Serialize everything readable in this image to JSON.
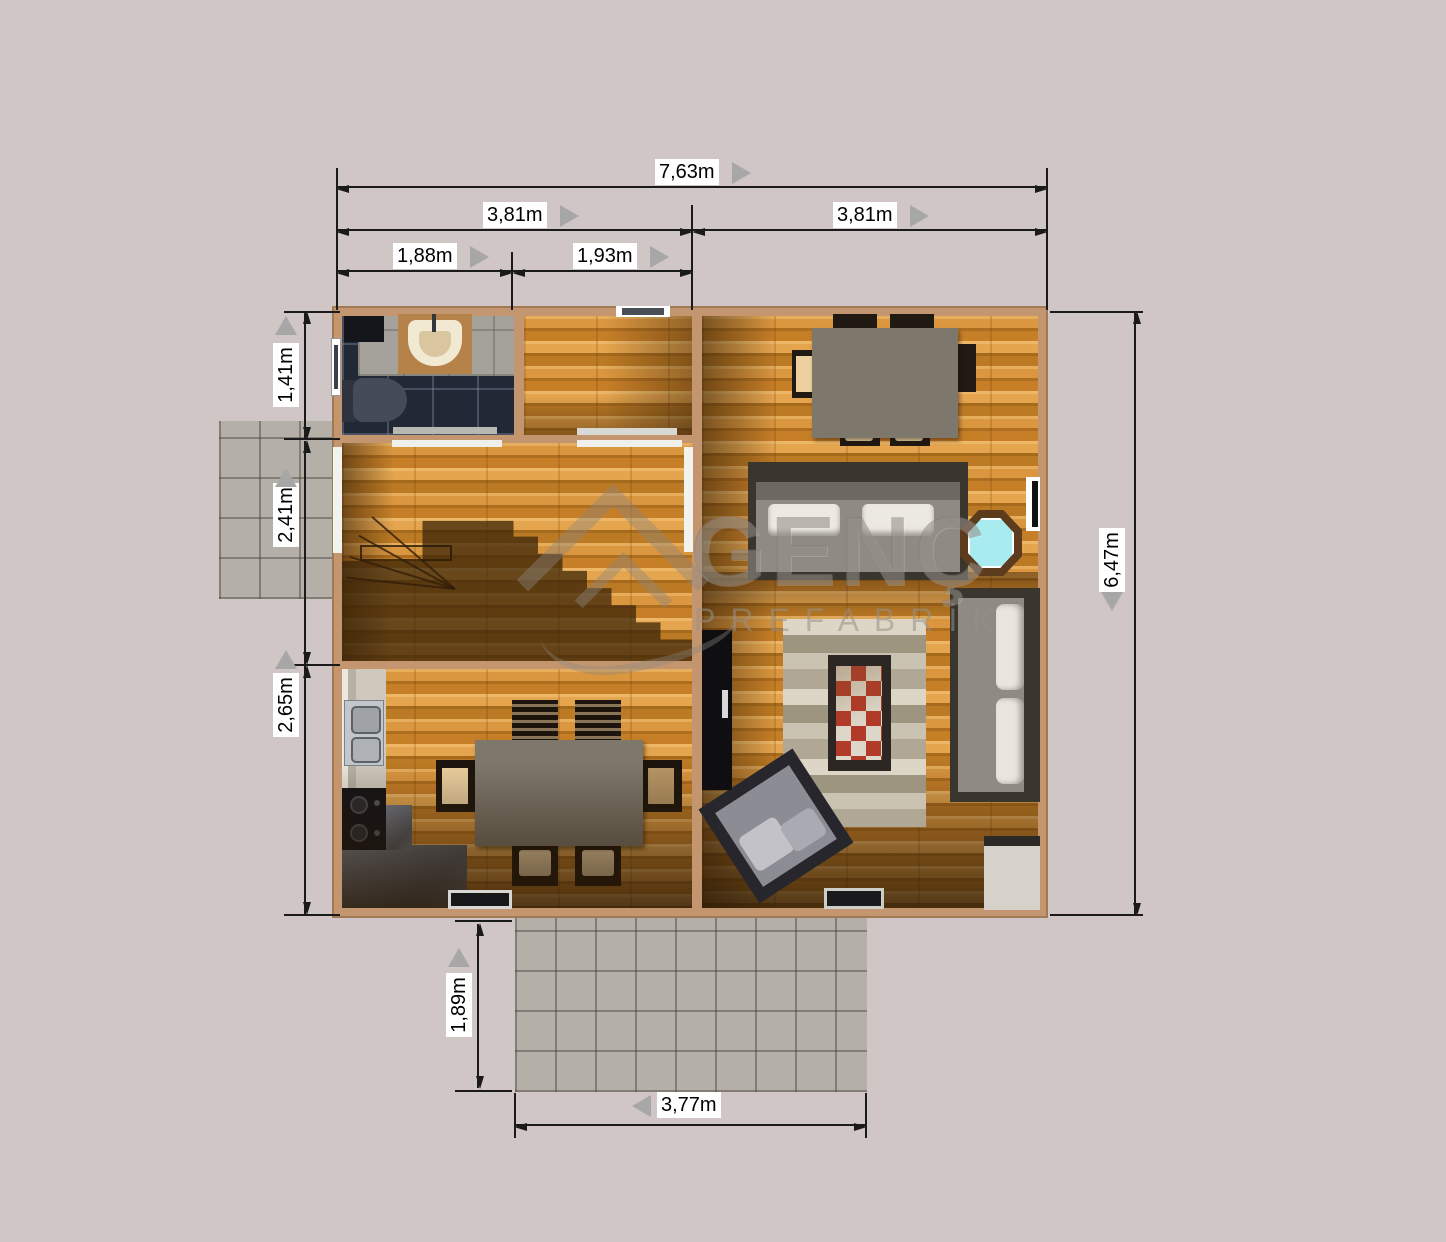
{
  "watermark": {
    "brand": "GENÇ",
    "subtitle": "PREFABRİK"
  },
  "dims": {
    "total_width": "7,63m",
    "left_half_width": "3,81m",
    "right_half_width": "3,81m",
    "bathroom_width": "1,88m",
    "small_room_width": "1,93m",
    "bathroom_depth": "1,41m",
    "hallway_depth": "2,41m",
    "kitchen_depth": "2,65m",
    "total_depth": "6,47m",
    "porch_depth": "1,89m",
    "porch_width": "3,77m"
  },
  "colors": {
    "page_background": "#cfc6c5",
    "wall": "#c4966f",
    "wood_floor": "#d18e37",
    "bathroom_tile_dark": "#232a37",
    "patio_tile": "#b4afa7",
    "stone_floor": "#6e7380",
    "dimension_line": "#1a1a1a",
    "dimension_label_bg": "#ffffff",
    "pointer_triangle": "#a7a7a7",
    "watermark_gray": "#8a847c",
    "table_top": "#7e786c",
    "sofa_cushion": "#ece9e1",
    "side_table_top": "#a8ecf0",
    "rug_accent_red": "#b23a28"
  }
}
